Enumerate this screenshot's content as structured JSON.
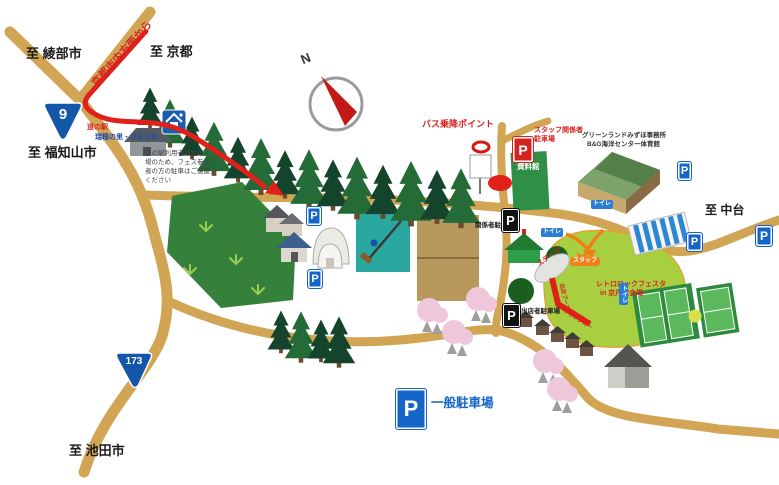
{
  "map": {
    "compass_north": "N",
    "shields": {
      "route_9": "9",
      "route_173": "173"
    },
    "directions": {
      "to_ayabe": "至 綾部市",
      "from_kyoto_city": "京都市内方面から",
      "to_kyoto": "至 京都",
      "to_fukuchiyama": "至 福知山市",
      "to_nakadai": "至 中台",
      "to_ikeda": "至 池田市"
    },
    "roadside_station": {
      "name_line1": "道の駅",
      "name_line2": "瑞穂の里・さらびき",
      "notice_lines": [
        "道の駅利用者様駐車",
        "場のため、フェス参加",
        "者の方の駐車はご遠慮",
        "ください"
      ]
    },
    "bus_point_label": "バス乗降ポイント",
    "parking": {
      "letter": "P",
      "staff_line1": "スタッフ関係者",
      "staff_line2": "駐車場",
      "officials": "関係者駐車場",
      "vendors": "出店者駐車場",
      "general": "一般駐車場"
    },
    "facilities": {
      "museum": "資料館",
      "office_line1": "グリーンランドみずほ事務所",
      "gym_line2": "B&G海洋センター体育館",
      "toilet": "トイレ",
      "stage": "ステージ",
      "staff": "スタッフ"
    },
    "venue": {
      "name_line1": "レトロロックフェスタ",
      "name_line2": "in 京丹波会場",
      "booth_label_1": "出店ブース",
      "booth_label_2": "キッチンカー"
    },
    "colors": {
      "road": "#d1a553",
      "route_red": "#e0201a",
      "field_green": "#a8cf3f",
      "parking_blue": "#1565c8",
      "forest_green": "#1c4f30"
    }
  }
}
